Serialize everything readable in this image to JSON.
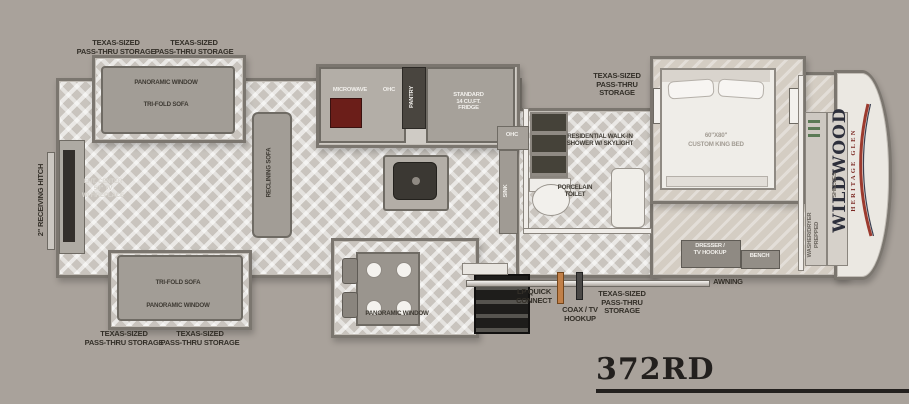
{
  "colors": {
    "background": "#a9a29b",
    "range_red": "#6b1e19",
    "lp_orange": "#c18049",
    "logo_red": "#9c3a2e",
    "logo_navy": "#2d2f3b",
    "label_text": "#332f28"
  },
  "model": "372RD",
  "brand": {
    "name": "WILDWOOD",
    "series": "HERITAGE GLEN"
  },
  "exterior": {
    "hitch": "2\" RECEIVING HITCH",
    "awning": "AWNING",
    "lp_quick_connect": "LP QUICK\nCONNECT",
    "coax_tv_hookup": "COAX / TV\nHOOKUP",
    "pass_thru_storage_2line": "TEXAS-SIZED\nPASS-THRU STORAGE",
    "pass_thru_storage_3line": "TEXAS-SIZED\nPASS-THRU\nSTORAGE"
  },
  "living": {
    "panoramic_window": "PANORAMIC WINDOW",
    "tri_fold_sofa": "TRI-FOLD SOFA",
    "reclining_sofa": "RECLINING SOFA",
    "ent_center": "ENT. CENTER\n50\" TV\nW/ FIREPLACE"
  },
  "kitchen": {
    "microwave": "MICROWAVE",
    "ohc": "OHC",
    "pantry": "PANTRY",
    "fridge": "STANDARD\n14 CU.FT.\nFRIDGE",
    "panoramic_window": "PANORAMIC WINDOW"
  },
  "bath": {
    "ohc": "OHC",
    "sink": "SINK",
    "shower": "RESIDENTIAL WALK-IN\nSHOWER W/ SKYLIGHT",
    "toilet": "PORCELAIN\nTOILET"
  },
  "bedroom": {
    "bed_size": "60\"X80\"",
    "bed_type": "CUSTOM KING BED",
    "dresser": "DRESSER /\nTV HOOKUP",
    "bench": "BENCH",
    "shelves": "SHELVES",
    "washer_dryer": "WASHER/DRYER\nPREPPED"
  }
}
